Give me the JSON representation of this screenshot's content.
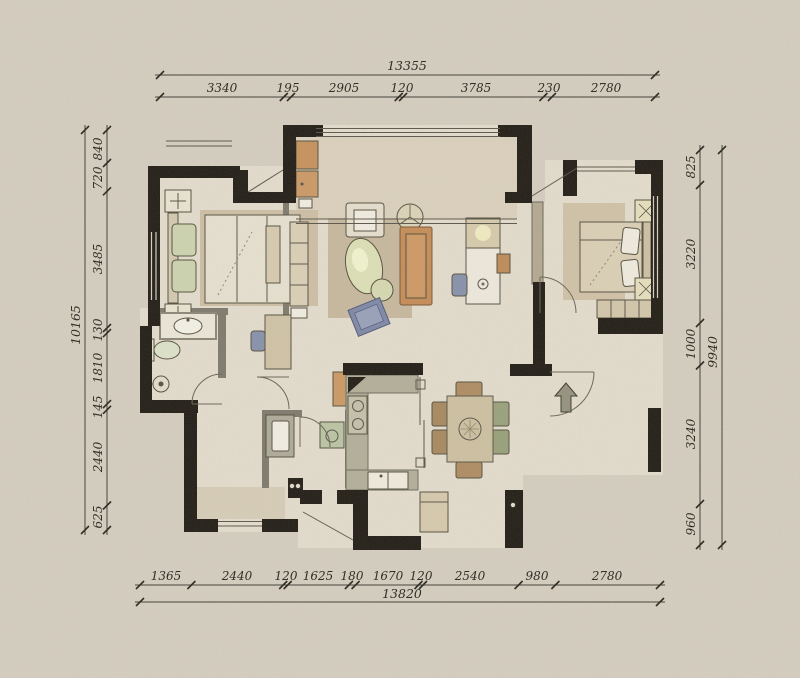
{
  "dimensions": {
    "top": {
      "total": "13355",
      "segments": [
        "3340",
        "195",
        "2905",
        "120",
        "3785",
        "230",
        "2780"
      ]
    },
    "bottom": {
      "total": "13820",
      "segments": [
        "1365",
        "2440",
        "120",
        "1625",
        "180",
        "1670",
        "120",
        "2540",
        "980",
        "2780"
      ]
    },
    "left": {
      "total": "10165",
      "segments": [
        "840",
        "720",
        "3485",
        "130",
        "1810",
        "145",
        "2440",
        "625"
      ]
    },
    "right": {
      "total": "9940",
      "segments": [
        "825",
        "3220",
        "1000",
        "3240",
        "960"
      ]
    }
  },
  "icons": {
    "entry_arrow": "up-arrow"
  },
  "colors": {
    "paper_background": "#d7d0c2",
    "wall": "#1f1b14",
    "floor": "#e6dfd0",
    "rug": "#c9baa0",
    "sofa_orange": "#c78d57",
    "cabinet_orange": "#cd9a64",
    "chair_blue": "#8792ad",
    "ottoman_blue": "#7f89a8",
    "counter_gray": "#b3b09a",
    "appliance_green": "#bcc7a6",
    "dining_chair_brown": "#b08d62",
    "dining_chair_green": "#9aa37c",
    "arrow_gray": "#95937f"
  }
}
